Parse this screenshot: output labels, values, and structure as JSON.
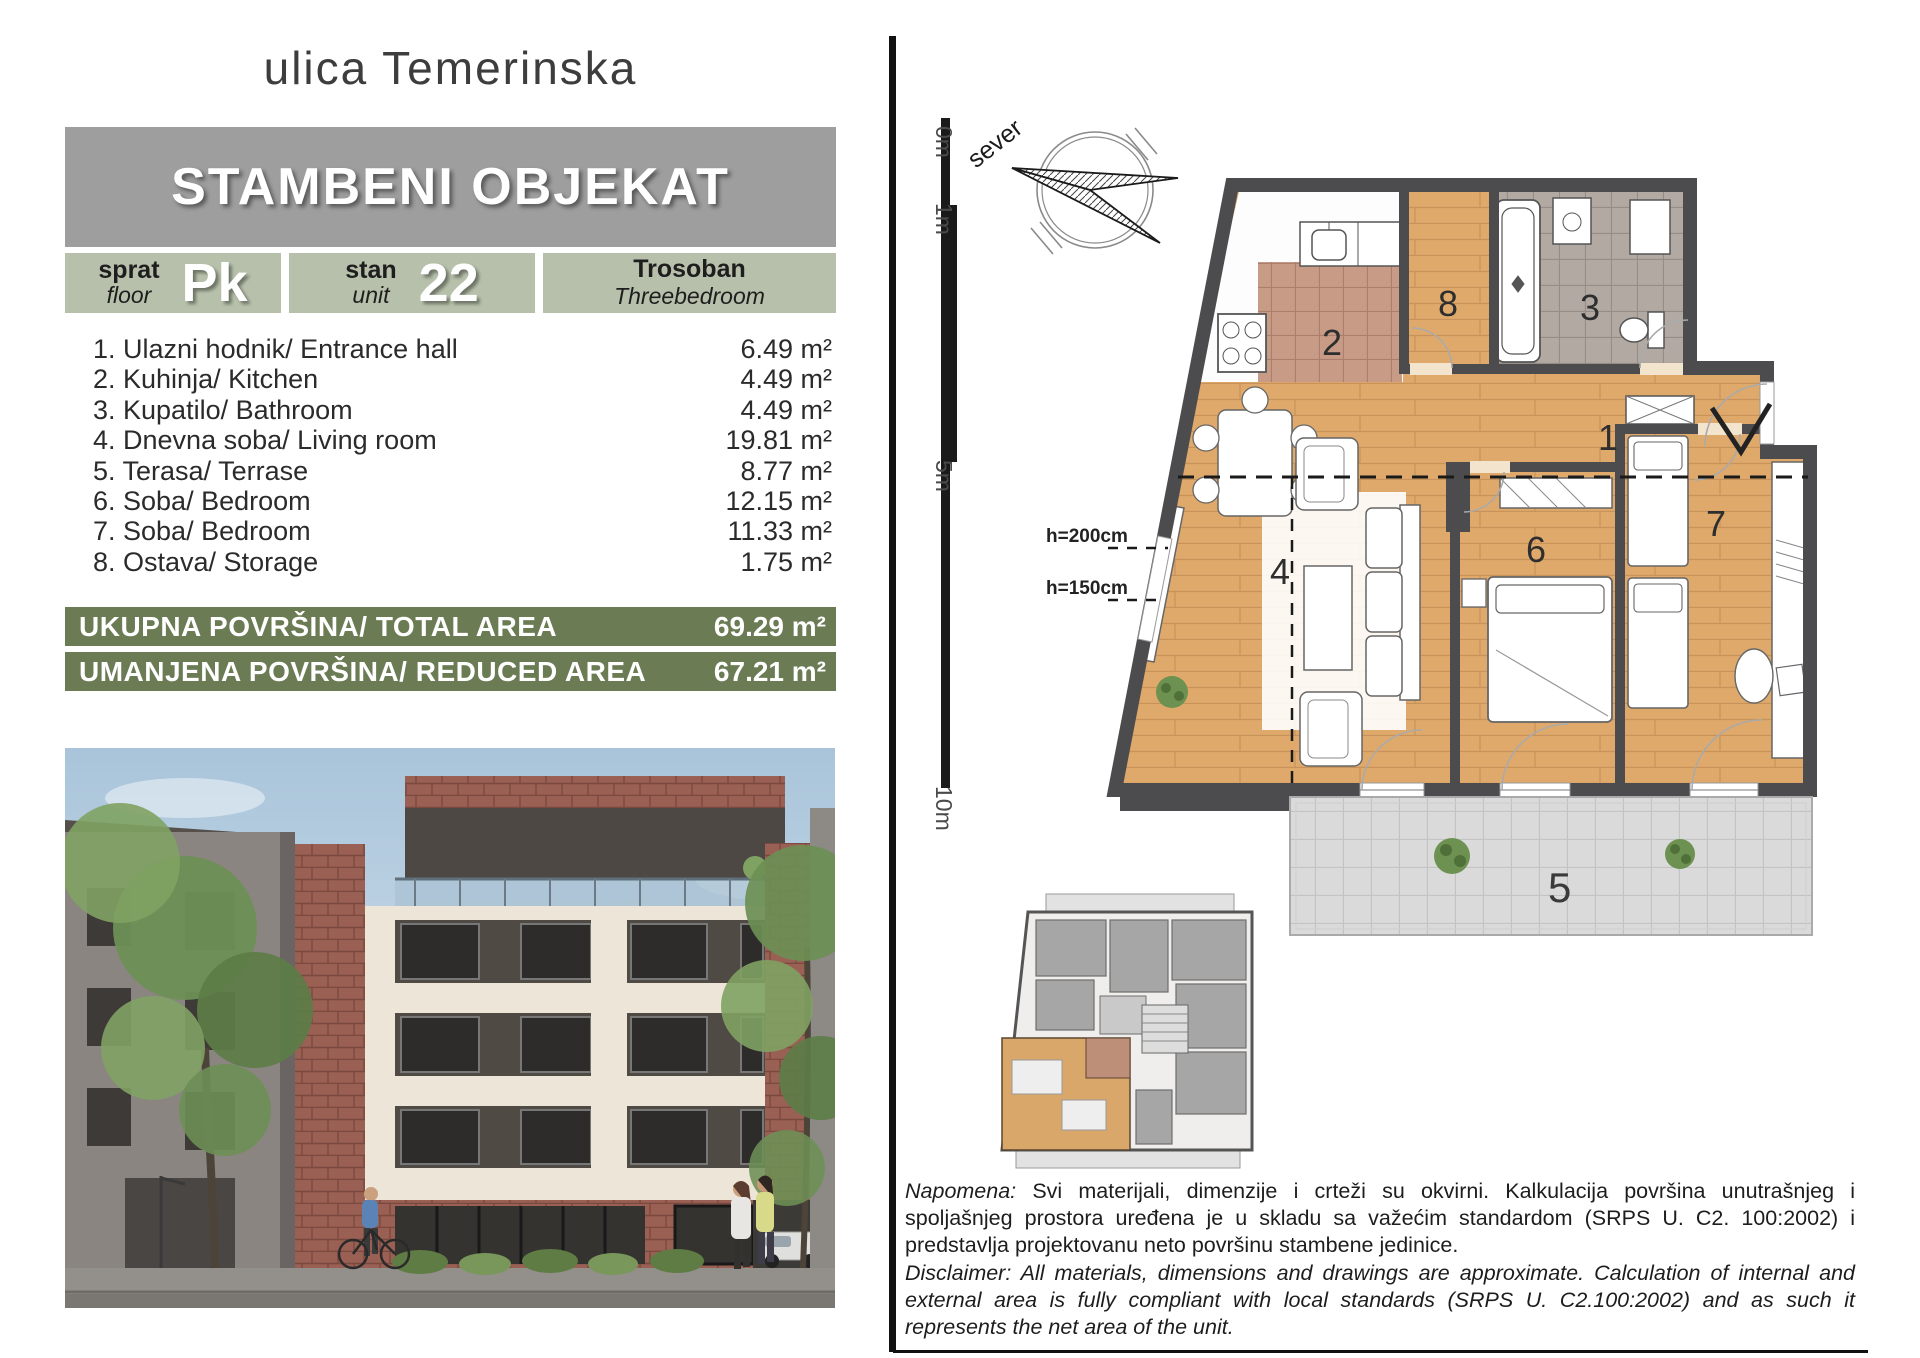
{
  "page": {
    "street_title": "ulica Temerinska"
  },
  "header": {
    "title": "STAMBENI OBJEKAT"
  },
  "info": {
    "floor": {
      "label_sr": "sprat",
      "label_en": "floor",
      "value": "Pk"
    },
    "unit": {
      "label_sr": "stan",
      "label_en": "unit",
      "value": "22"
    },
    "type": {
      "label_sr": "Trosoban",
      "label_en": "Threebedroom"
    }
  },
  "rooms": [
    {
      "label": "1. Ulazni hodnik/ Entrance hall",
      "area": "6.49 m²"
    },
    {
      "label": "2. Kuhinja/ Kitchen",
      "area": "4.49 m²"
    },
    {
      "label": "3. Kupatilo/ Bathroom",
      "area": "4.49 m²"
    },
    {
      "label": "4. Dnevna soba/ Living room",
      "area": "19.81 m²"
    },
    {
      "label": "5. Terasa/ Terrase",
      "area": "8.77 m²"
    },
    {
      "label": "6. Soba/ Bedroom",
      "area": "12.15 m²"
    },
    {
      "label": "7. Soba/ Bedroom",
      "area": "11.33 m²"
    },
    {
      "label": "8. Ostava/ Storage",
      "area": "1.75 m²"
    }
  ],
  "totals": {
    "total": {
      "label": "UKUPNA POVRŠINA/ TOTAL AREA",
      "value": "69.29 m²"
    },
    "reduced": {
      "label": "UMANJENA POVRŠINA/ REDUCED AREA",
      "value": "67.21 m²"
    }
  },
  "plan": {
    "compass_label": "sever",
    "scale_labels": [
      "0m",
      "1m",
      "5m",
      "10m"
    ],
    "height_labels": [
      "h=200cm",
      "h=150cm"
    ],
    "room_numbers": {
      "hall": "1",
      "kitchen": "2",
      "bath": "3",
      "living": "4",
      "terrace": "5",
      "bedroom1": "6",
      "bedroom2": "7",
      "storage": "8"
    }
  },
  "notes": {
    "napomena_label": "Napomena:",
    "napomena_text": " Svi materijali, dimenzije i crteži su okvirni. Kalkulacija površina unutrašnjeg i spoljašnjeg prostora uređena je u skladu sa važećim standardom (SRPS U. C2. 100:2002) i predstavlja projektovanu neto površinu stambene jedinice.",
    "disclaimer_label": "Disclaimer:",
    "disclaimer_text": " All materials, dimensions and drawings are approximate. Calculation of internal and external area is fully compliant with local standards (SRPS U. C2.100:2002) and as such it represents the net area of the unit."
  },
  "colors": {
    "header_bg": "#9e9e9e",
    "box_bg": "#b6c0aa",
    "bar_bg": "#6b7b54",
    "wood": "#dfa96b",
    "wall": "#4c4c4e",
    "terrace_tile": "#dadada"
  }
}
